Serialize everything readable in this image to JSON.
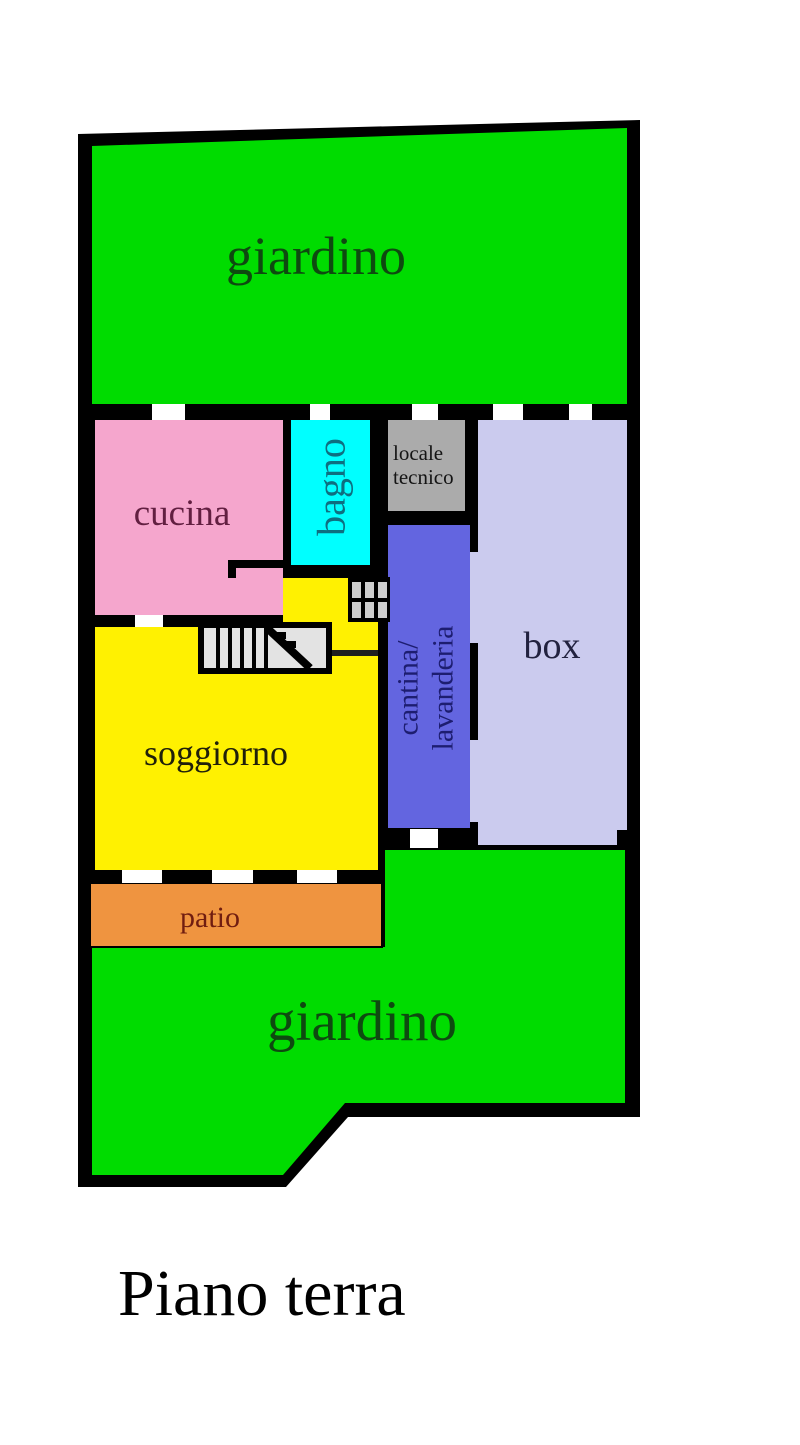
{
  "title": {
    "label": "Piano terra",
    "color": "#000000"
  },
  "colors": {
    "wall": "#000000",
    "opening": "#ffffff",
    "stairs_fill": "#e3e3e3",
    "hatch_cell": "#cfcfcf",
    "handrail": "#1f1f1f"
  },
  "rooms": {
    "giardino_top": {
      "label": "giardino",
      "fill": "#00dc00",
      "label_color": "#0e4a10"
    },
    "cucina": {
      "label": "cucina",
      "fill": "#f5a6cd",
      "label_color": "#621f41"
    },
    "bagno": {
      "label": "bagno",
      "fill": "#00ffff",
      "label_color": "#0e6f80"
    },
    "locale_tecnico": {
      "label_line1": "locale",
      "label_line2": "tecnico",
      "fill": "#ababab",
      "label_color": "#141414"
    },
    "box": {
      "label": "box",
      "fill": "#cbcbee",
      "label_color": "#22223f"
    },
    "cantina_lavanderia": {
      "label_line1": "cantina/",
      "label_line2": "lavanderia",
      "fill": "#6365e0",
      "label_color": "#1d1d70"
    },
    "soggiorno": {
      "label": "soggiorno",
      "fill": "#fff101",
      "label_color": "#20200a"
    },
    "patio": {
      "label": "patio",
      "fill": "#ef9440",
      "label_color": "#701d10"
    },
    "giardino_bottom": {
      "label": "giardino",
      "fill": "#00dc00",
      "label_color": "#0e4a10"
    }
  }
}
